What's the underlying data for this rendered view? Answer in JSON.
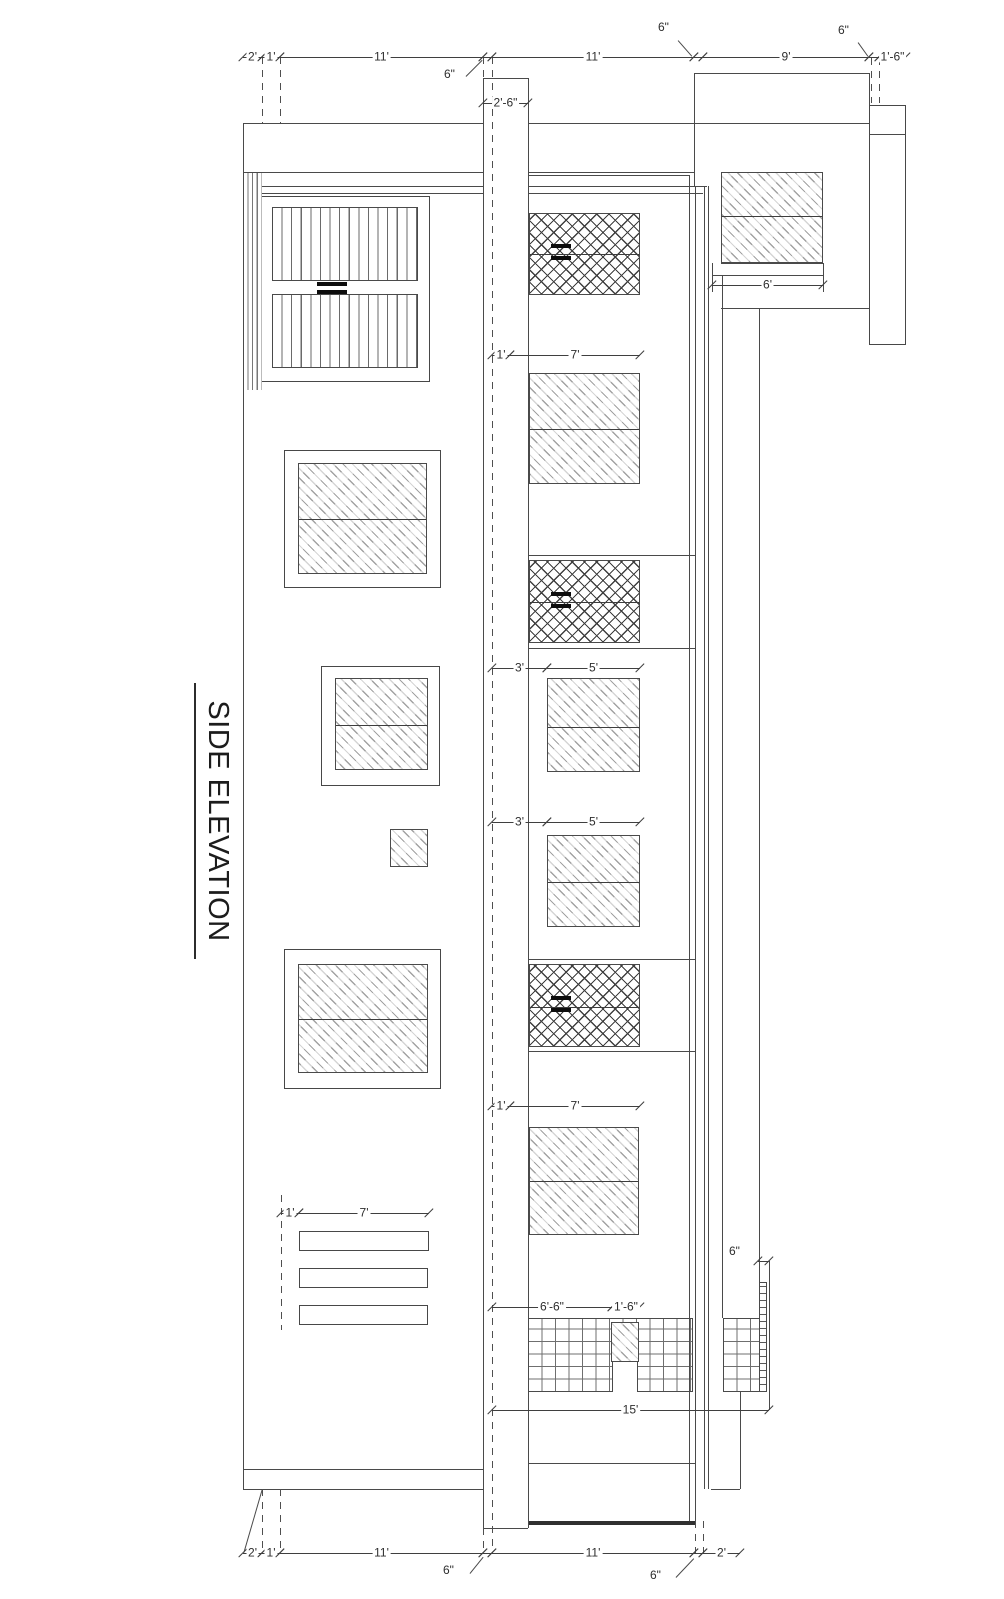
{
  "title": {
    "text": "SIDE ELEVATION"
  },
  "drawing": {
    "palette": {
      "line": "#4a4a4a",
      "dim_text": "#2e2e2e",
      "hatch": "#a2a2a2",
      "crosshatch": "#3f3f3f",
      "background": "#ffffff"
    },
    "h_lines": [
      {
        "x": 694,
        "y": 73,
        "w": 175
      },
      {
        "x": 243,
        "y": 123,
        "w": 240
      },
      {
        "x": 528,
        "y": 123,
        "w": 341
      },
      {
        "x": 243,
        "y": 172,
        "w": 240
      },
      {
        "x": 528,
        "y": 172,
        "w": 167
      },
      {
        "x": 483,
        "y": 78,
        "w": 45
      },
      {
        "x": 529,
        "y": 175,
        "w": 160
      },
      {
        "x": 262,
        "y": 186,
        "w": 221
      },
      {
        "x": 529,
        "y": 186,
        "w": 178
      },
      {
        "x": 262,
        "y": 193,
        "w": 221
      },
      {
        "x": 529,
        "y": 193,
        "w": 174
      },
      {
        "x": 869,
        "y": 134,
        "w": 37
      },
      {
        "x": 721,
        "y": 263,
        "w": 102
      },
      {
        "x": 712,
        "y": 275,
        "w": 111
      },
      {
        "x": 721,
        "y": 308,
        "w": 148
      },
      {
        "x": 529,
        "y": 555,
        "w": 166
      },
      {
        "x": 529,
        "y": 648,
        "w": 166
      },
      {
        "x": 529,
        "y": 959,
        "w": 166
      },
      {
        "x": 529,
        "y": 1051,
        "w": 166
      },
      {
        "x": 529,
        "y": 1463,
        "w": 166
      },
      {
        "x": 243,
        "y": 1469,
        "w": 240
      },
      {
        "x": 243,
        "y": 1489,
        "w": 240
      },
      {
        "x": 711,
        "y": 1489,
        "w": 29
      },
      {
        "x": 483,
        "y": 1528,
        "w": 45
      },
      {
        "x": 529,
        "y": 1521,
        "w": 166,
        "t": 4,
        "dark": true
      }
    ],
    "v_lines": [
      {
        "x": 243,
        "y": 123,
        "h": 1366
      },
      {
        "x": 694,
        "y": 73,
        "h": 113
      },
      {
        "x": 689,
        "y": 175,
        "h": 1346
      },
      {
        "x": 695,
        "y": 186,
        "h": 1335
      },
      {
        "x": 704,
        "y": 186,
        "h": 1303
      },
      {
        "x": 708,
        "y": 186,
        "h": 1303
      },
      {
        "x": 722,
        "y": 276,
        "h": 1042
      },
      {
        "x": 759,
        "y": 308,
        "h": 974
      },
      {
        "x": 740,
        "y": 1392,
        "h": 97
      },
      {
        "x": 483,
        "y": 78,
        "h": 1450
      },
      {
        "x": 528,
        "y": 78,
        "h": 1450
      },
      {
        "x": 869,
        "y": 73,
        "h": 32
      },
      {
        "x": 769,
        "y": 1261,
        "h": 149
      },
      {
        "x": 712,
        "y": 263,
        "h": 29
      },
      {
        "x": 823,
        "y": 263,
        "h": 29
      }
    ],
    "dashed_v": [
      {
        "x": 262,
        "y": 57,
        "h": 66
      },
      {
        "x": 280,
        "y": 57,
        "h": 66
      },
      {
        "x": 492,
        "y": 57,
        "h": 1496
      },
      {
        "x": 483,
        "y": 57,
        "h": 21
      },
      {
        "x": 871,
        "y": 58,
        "h": 45
      },
      {
        "x": 879,
        "y": 58,
        "h": 45
      },
      {
        "x": 262,
        "y": 1489,
        "h": 64
      },
      {
        "x": 280,
        "y": 1489,
        "h": 64
      },
      {
        "x": 483,
        "y": 1528,
        "h": 25
      },
      {
        "x": 695,
        "y": 1521,
        "h": 32
      },
      {
        "x": 703,
        "y": 1521,
        "h": 32
      },
      {
        "x": 281,
        "y": 1195,
        "h": 135
      }
    ],
    "leaders": [
      {
        "x1": 466,
        "y1": 76,
        "x2": 482,
        "y2": 60
      },
      {
        "x1": 678,
        "y1": 40,
        "x2": 692,
        "y2": 56
      },
      {
        "x1": 858,
        "y1": 42,
        "x2": 868,
        "y2": 56
      },
      {
        "x1": 470,
        "y1": 1573,
        "x2": 483,
        "y2": 1557
      },
      {
        "x1": 676,
        "y1": 1577,
        "x2": 694,
        "y2": 1558
      },
      {
        "x1": 244,
        "y1": 1552,
        "x2": 262,
        "y2": 1490
      }
    ],
    "frames": [
      {
        "x": 259,
        "y": 196,
        "w": 171,
        "h": 186,
        "name": "louver-window-frame"
      },
      {
        "x": 284,
        "y": 450,
        "w": 157,
        "h": 138,
        "name": "window-frame"
      },
      {
        "x": 321,
        "y": 666,
        "w": 119,
        "h": 120,
        "name": "window-frame"
      },
      {
        "x": 284,
        "y": 949,
        "w": 157,
        "h": 140,
        "name": "window-frame"
      },
      {
        "x": 869,
        "y": 105,
        "w": 37,
        "h": 240,
        "name": "wall-return"
      },
      {
        "x": 299,
        "y": 1231,
        "w": 130,
        "h": 20,
        "name": "vent-slat"
      },
      {
        "x": 299,
        "y": 1268,
        "w": 129,
        "h": 20,
        "name": "vent-slat"
      },
      {
        "x": 299,
        "y": 1305,
        "w": 129,
        "h": 20,
        "name": "vent-slat"
      }
    ],
    "windows": [
      {
        "kind": "edgehatch",
        "x": 244,
        "y": 172,
        "w": 18,
        "h": 218
      },
      {
        "kind": "louver",
        "x": 272,
        "y": 207,
        "w": 146,
        "h": 74
      },
      {
        "kind": "louver",
        "x": 272,
        "y": 294,
        "w": 146,
        "h": 74
      },
      {
        "kind": "crosshatch",
        "x": 529,
        "y": 213,
        "w": 111,
        "h": 82,
        "split": 40
      },
      {
        "kind": "hatch",
        "x": 529,
        "y": 373,
        "w": 111,
        "h": 111,
        "split": 55
      },
      {
        "kind": "crosshatch",
        "x": 529,
        "y": 560,
        "w": 111,
        "h": 83,
        "split": 41
      },
      {
        "kind": "hatch",
        "x": 547,
        "y": 678,
        "w": 93,
        "h": 94,
        "split": 48
      },
      {
        "kind": "hatch",
        "x": 547,
        "y": 835,
        "w": 93,
        "h": 92,
        "split": 46
      },
      {
        "kind": "crosshatch",
        "x": 529,
        "y": 964,
        "w": 111,
        "h": 83,
        "split": 42
      },
      {
        "kind": "hatch",
        "x": 529,
        "y": 1127,
        "w": 110,
        "h": 108,
        "split": 53
      },
      {
        "kind": "hatch",
        "x": 298,
        "y": 463,
        "w": 129,
        "h": 111,
        "split": 55
      },
      {
        "kind": "hatch",
        "x": 335,
        "y": 678,
        "w": 93,
        "h": 92,
        "split": 46
      },
      {
        "kind": "hatch",
        "x": 390,
        "y": 829,
        "w": 38,
        "h": 38
      },
      {
        "kind": "hatch",
        "x": 298,
        "y": 964,
        "w": 130,
        "h": 109,
        "split": 54
      },
      {
        "kind": "hatch",
        "x": 721,
        "y": 172,
        "w": 102,
        "h": 91,
        "split": 43
      },
      {
        "kind": "brick",
        "x": 528,
        "y": 1318,
        "w": 165,
        "h": 74
      },
      {
        "kind": "hatch",
        "x": 611,
        "y": 1322,
        "w": 28,
        "h": 40
      },
      {
        "kind": "blank",
        "x": 612,
        "y": 1362,
        "w": 26,
        "h": 30
      },
      {
        "kind": "brick",
        "x": 723,
        "y": 1318,
        "w": 44,
        "h": 74
      },
      {
        "kind": "downspout",
        "x": 759,
        "y": 1282,
        "w": 8,
        "h": 110
      }
    ],
    "handle_bars": [
      {
        "x": 317,
        "y": 282,
        "w": 30,
        "h": 4
      },
      {
        "x": 317,
        "y": 290,
        "w": 30,
        "h": 4
      },
      {
        "x": 551,
        "y": 244,
        "w": 20,
        "h": 4
      },
      {
        "x": 551,
        "y": 256,
        "w": 20,
        "h": 4
      },
      {
        "x": 551,
        "y": 592,
        "w": 20,
        "h": 4
      },
      {
        "x": 551,
        "y": 604,
        "w": 20,
        "h": 4
      },
      {
        "x": 551,
        "y": 996,
        "w": 20,
        "h": 4
      },
      {
        "x": 551,
        "y": 1008,
        "w": 20,
        "h": 4
      }
    ],
    "dims": [
      {
        "x1": 243,
        "x2": 262,
        "y": 57,
        "label": "2'"
      },
      {
        "x1": 262,
        "x2": 280,
        "y": 57,
        "label": "1'"
      },
      {
        "x1": 280,
        "x2": 483,
        "y": 57,
        "label": "11'"
      },
      {
        "x1": 483,
        "x2": 492,
        "y": 57,
        "label": ""
      },
      {
        "x1": 492,
        "x2": 694,
        "y": 57,
        "label": "11'"
      },
      {
        "x1": 694,
        "x2": 703,
        "y": 57,
        "label": ""
      },
      {
        "x1": 703,
        "x2": 869,
        "y": 57,
        "label": "9'"
      },
      {
        "x1": 869,
        "x2": 879,
        "y": 57,
        "label": ""
      },
      {
        "x1": 879,
        "x2": 906,
        "y": 57,
        "label": "1'-6\""
      },
      {
        "x1": 483,
        "x2": 528,
        "y": 103,
        "label": "2'-6\""
      },
      {
        "x1": 492,
        "x2": 510,
        "y": 355,
        "label": "1'"
      },
      {
        "x1": 510,
        "x2": 640,
        "y": 355,
        "label": "7'"
      },
      {
        "x1": 492,
        "x2": 547,
        "y": 668,
        "label": "3'"
      },
      {
        "x1": 547,
        "x2": 640,
        "y": 668,
        "label": "5'"
      },
      {
        "x1": 492,
        "x2": 547,
        "y": 822,
        "label": "3'"
      },
      {
        "x1": 547,
        "x2": 640,
        "y": 822,
        "label": "5'"
      },
      {
        "x1": 492,
        "x2": 510,
        "y": 1106,
        "label": "1'"
      },
      {
        "x1": 510,
        "x2": 640,
        "y": 1106,
        "label": "7'"
      },
      {
        "x1": 281,
        "x2": 299,
        "y": 1213,
        "label": "1'"
      },
      {
        "x1": 299,
        "x2": 429,
        "y": 1213,
        "label": "7'"
      },
      {
        "x1": 712,
        "x2": 823,
        "y": 285,
        "label": "6'"
      },
      {
        "x1": 492,
        "x2": 612,
        "y": 1307,
        "label": "6'-6\""
      },
      {
        "x1": 612,
        "x2": 640,
        "y": 1307,
        "label": "1'-6\""
      },
      {
        "x1": 758,
        "x2": 769,
        "y": 1261,
        "label": ""
      },
      {
        "x1": 492,
        "x2": 769,
        "y": 1410,
        "label": "15'"
      },
      {
        "x1": 243,
        "x2": 262,
        "y": 1553,
        "label": "2'"
      },
      {
        "x1": 262,
        "x2": 280,
        "y": 1553,
        "label": "1'"
      },
      {
        "x1": 280,
        "x2": 483,
        "y": 1553,
        "label": "11'"
      },
      {
        "x1": 483,
        "x2": 492,
        "y": 1553,
        "label": ""
      },
      {
        "x1": 492,
        "x2": 694,
        "y": 1553,
        "label": "11'"
      },
      {
        "x1": 694,
        "x2": 703,
        "y": 1553,
        "label": ""
      },
      {
        "x1": 703,
        "x2": 740,
        "y": 1553,
        "label": "2'"
      }
    ],
    "free_labels": [
      {
        "x": 442,
        "y": 68,
        "text": "6\""
      },
      {
        "x": 656,
        "y": 21,
        "text": "6\""
      },
      {
        "x": 836,
        "y": 24,
        "text": "6\""
      },
      {
        "x": 441,
        "y": 1564,
        "text": "6\""
      },
      {
        "x": 648,
        "y": 1569,
        "text": "6\""
      },
      {
        "x": 727,
        "y": 1245,
        "text": "6\""
      }
    ]
  }
}
